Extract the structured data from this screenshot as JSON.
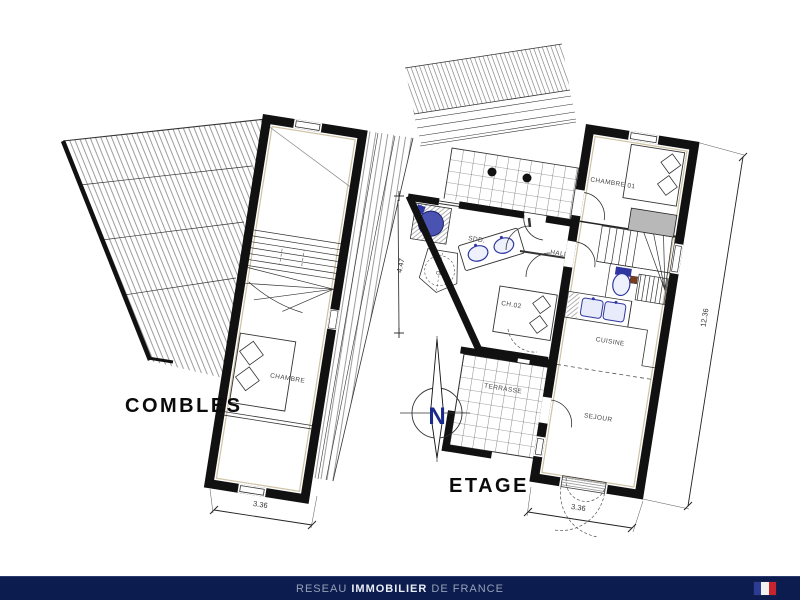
{
  "plans": {
    "combles": {
      "title": "COMBLES",
      "rooms": {
        "chambre": "CHAMBRE"
      },
      "dims": {
        "width": "3.36"
      }
    },
    "etage": {
      "title": "ETAGE",
      "rooms": {
        "chambre01": "CHAMBRE 01",
        "sdd": "SDD.",
        "hall": "HALL",
        "ch02": "CH.02",
        "cuisine": "CUISINE",
        "sejour": "SEJOUR",
        "terrasse": "TERRASSE",
        "water_heater": "CE"
      },
      "dims": {
        "width": "3.36",
        "side": "12.36",
        "annex": "4.47"
      }
    }
  },
  "compass": {
    "north_label": "N"
  },
  "footer": {
    "brand_prefix": "RESEAU",
    "brand_main": "IMMOBILIER",
    "brand_suffix": "DE FRANCE"
  },
  "colors": {
    "footer-bg": "#0c1c4e",
    "footer-dim": "#96a0b8",
    "footer-bright": "#e9edf6",
    "flag-blue": "#2b3c94",
    "flag-white": "#f2f2f2",
    "flag-red": "#c8242e",
    "fixture-blue": "#2f36a0",
    "shower-blue": "#4a52b2",
    "wardrobe-gray": "#b8b8b8",
    "compass-navy": "#1b2a8a"
  }
}
